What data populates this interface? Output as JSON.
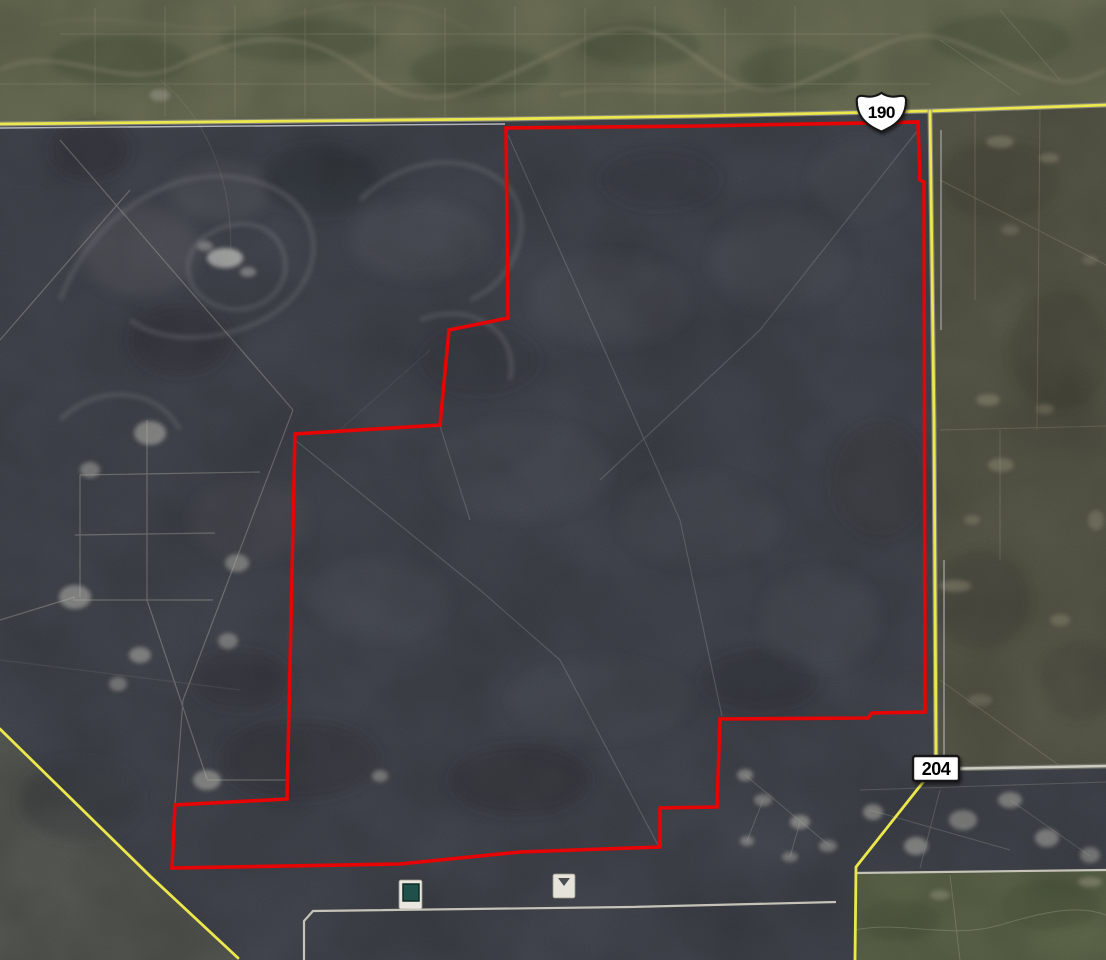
{
  "app": {
    "name": "satellite-map-view",
    "description": "Aerial satellite imagery with a red land-parcel boundary overlay and highway shields"
  },
  "map": {
    "shields": [
      {
        "label": "190",
        "type": "us-route-shield"
      },
      {
        "label": "204",
        "type": "county-road-sign"
      }
    ],
    "colors": {
      "parcel_boundary": "#e60404",
      "highway_yellow": "#ece74c",
      "terrain_dark": "#40444d",
      "terrain_scrub_top": "#6f7355",
      "terrain_scrub_east": "#585848",
      "terrain_green_southeast": "#5d6848",
      "road_white": "#cdcabf",
      "sign_background": "#ffffff",
      "sign_border": "#161616",
      "sign_text": "#000000",
      "frac_pond_green": "#20504a"
    },
    "parcel_boundary_points": "506,128 700,126 918,122 920,180 924,182 925,712 872,713 868,718 720,719 717,807 660,808 660,847 520,852 400,864 172,868 175,805 287,799 291,620 295,434 440,425 449,330 508,318",
    "roads": {
      "top_highway": "0,124 300,121 505,119 700,116 930,111 1106,105",
      "east_highway": "930,111 934,420 936,754",
      "east_highway_south": "936,754 924,781 856,867 855,960",
      "southwest_road": "0,729 52,780 150,876 238,958",
      "county_road_east": "939,769 1106,766",
      "southeast_boundary_road": "855,873 1106,870",
      "lease_road": "304,960 304,921 313,911 630,907 836,902",
      "section_line_top": "0,128 505,124"
    }
  }
}
